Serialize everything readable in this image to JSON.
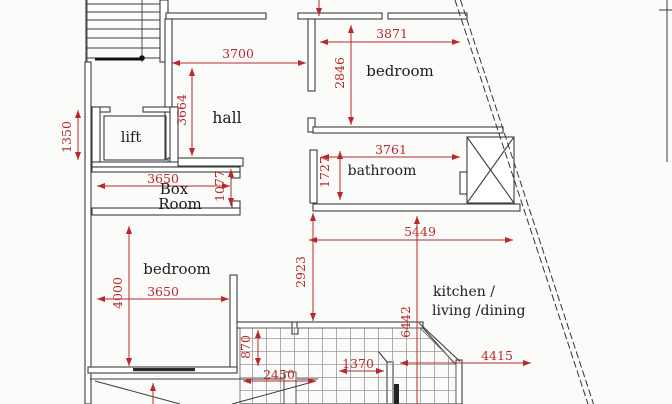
{
  "plan": {
    "title": "apartment-floor-plan",
    "rooms": {
      "hall": "hall",
      "lift": "lift",
      "box_room_line1": "Box",
      "box_room_line2": "Room",
      "bedroom_top": "bedroom",
      "bathroom": "bathroom",
      "bedroom_left": "bedroom",
      "kitchen_line1": "kitchen /",
      "kitchen_line2": "living /dining"
    },
    "dimensions": {
      "d3700": "3700",
      "d3664": "3664",
      "d3871": "3871",
      "d2846": "2846",
      "d1350": "1350",
      "d3650_box": "3650",
      "d1077": "1077",
      "d3761": "3761",
      "d1727": "1727",
      "d5449": "5449",
      "d2923": "2923",
      "d4000": "4000",
      "d3650_bed": "3650",
      "d870": "870",
      "d1370": "1370",
      "d2450": "2450",
      "d4415": "4415",
      "d6442": "6442"
    },
    "colors": {
      "dimension_red": "#b9292b",
      "wall_dark": "#3d3d3d",
      "background": "#fbfbfa",
      "tile_line": "#9a9a9a"
    }
  }
}
